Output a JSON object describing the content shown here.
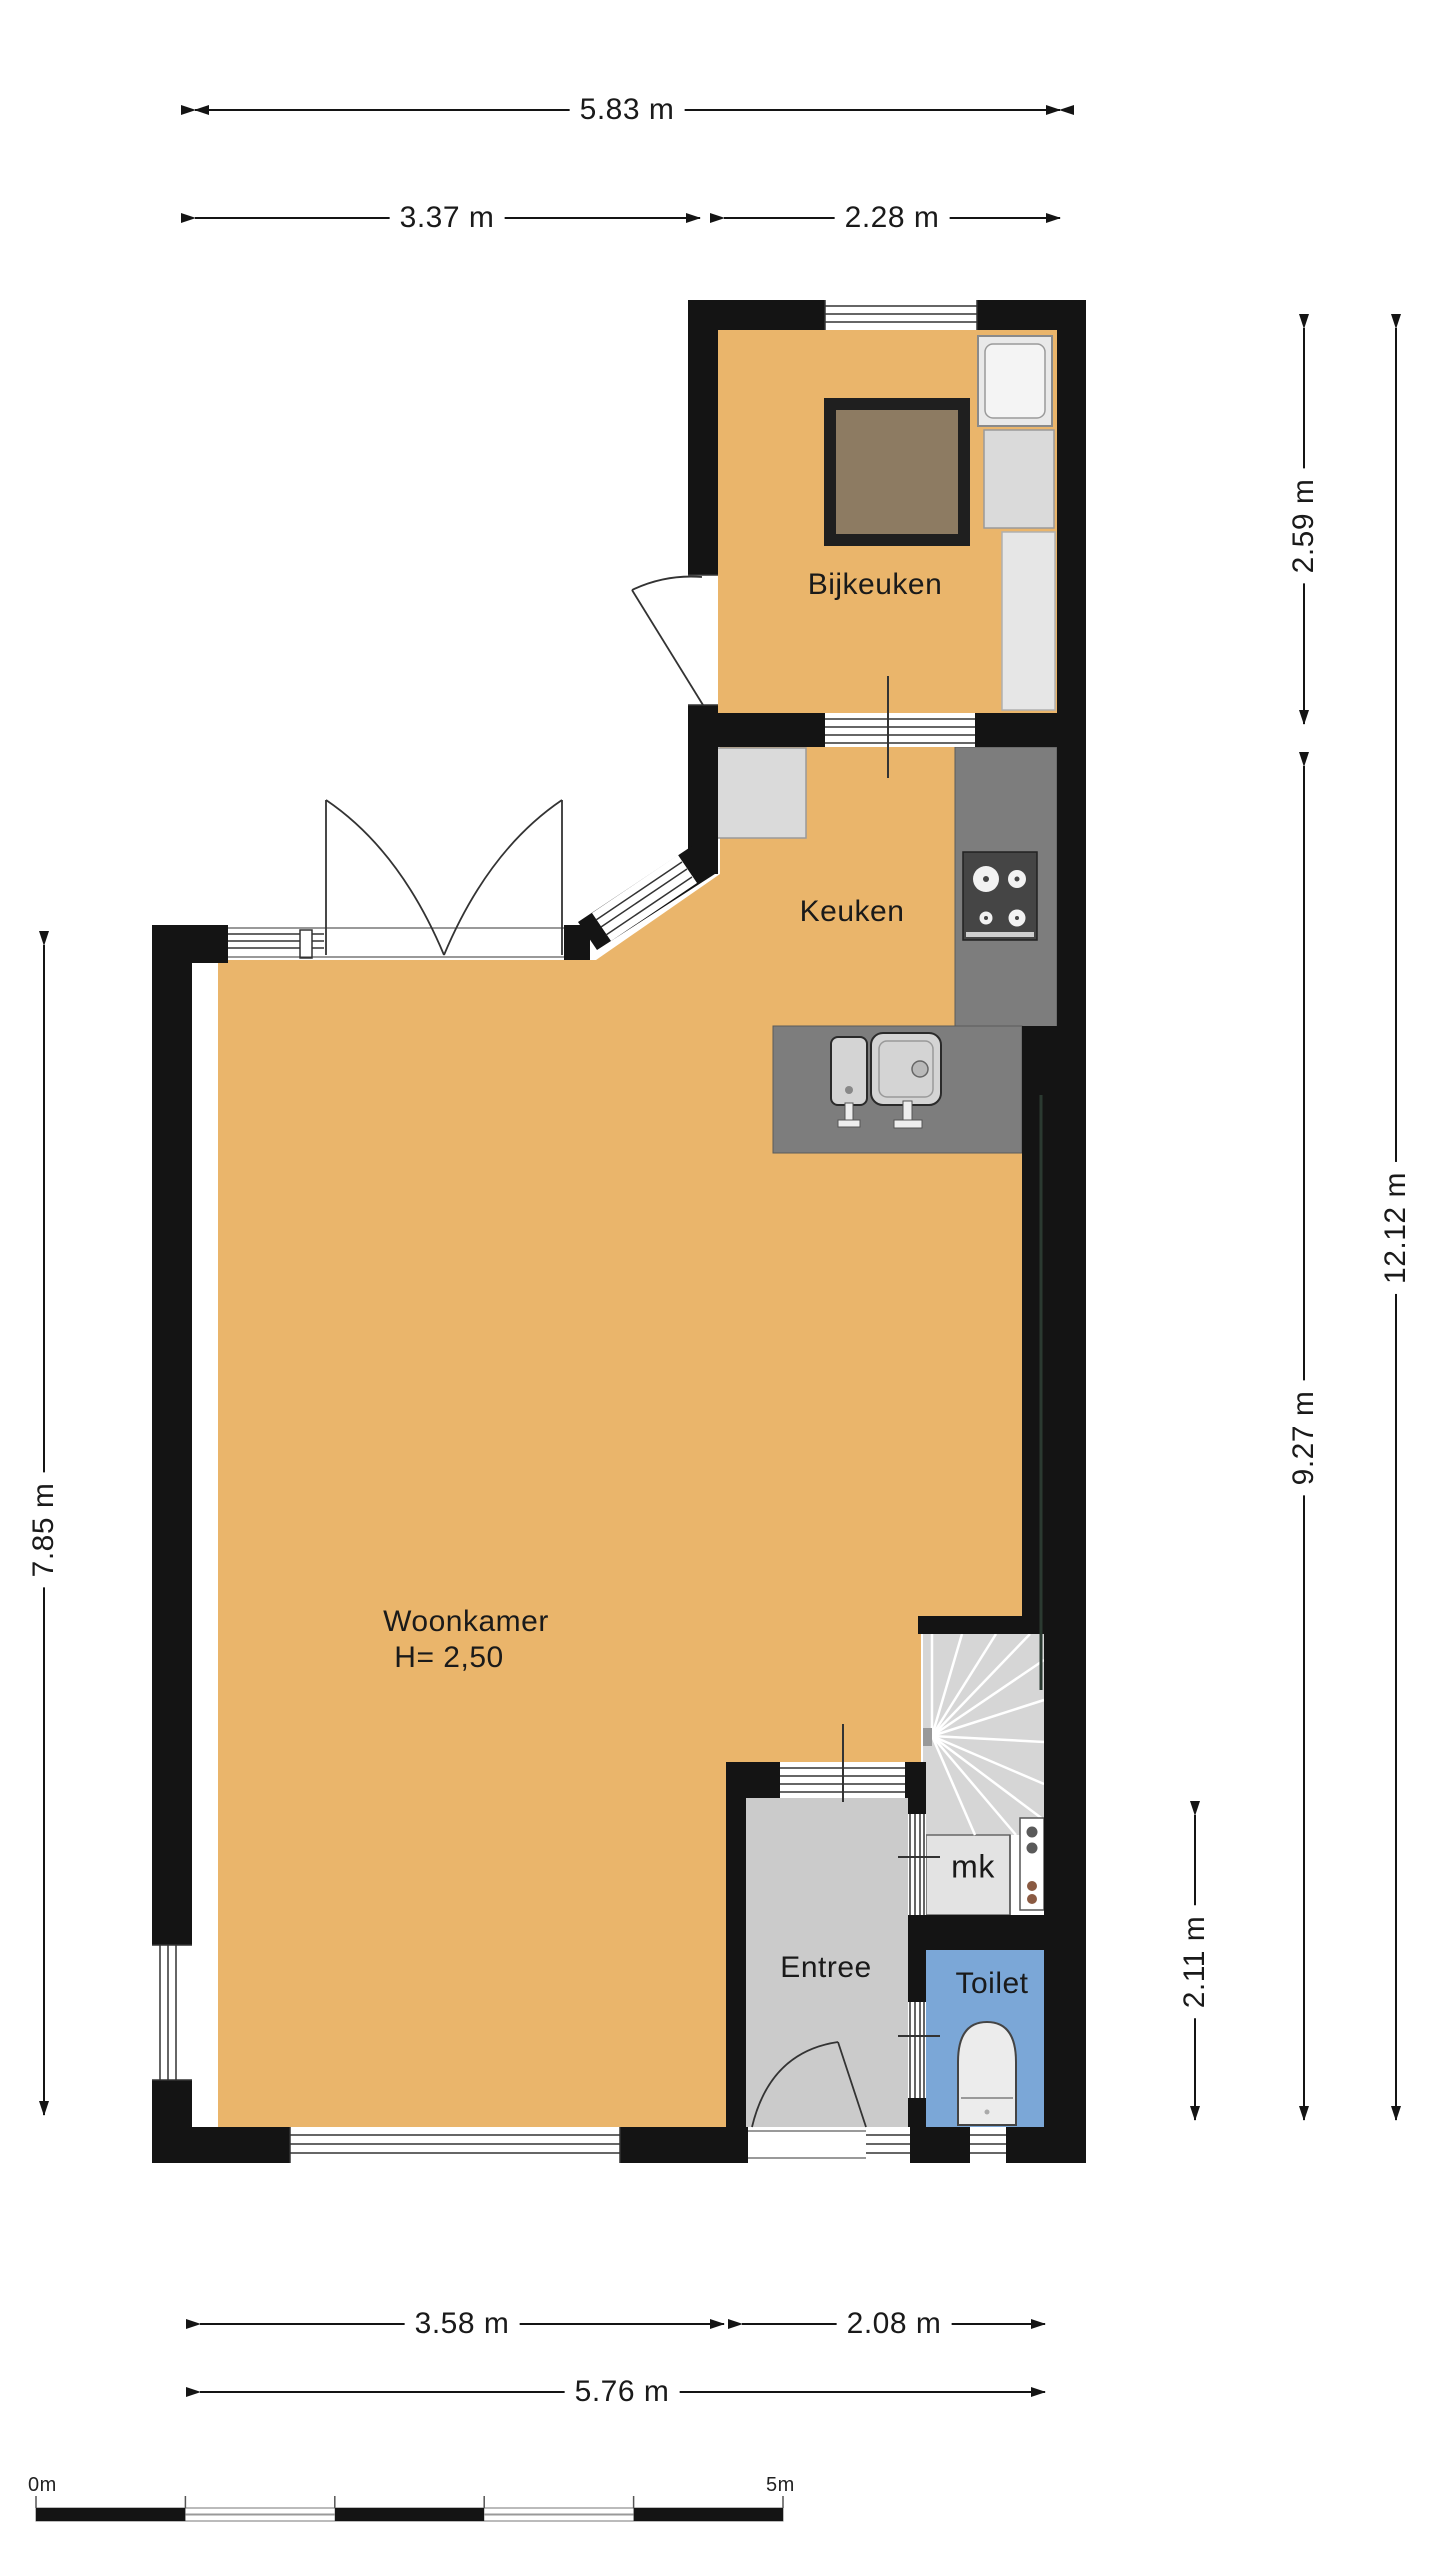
{
  "plan": {
    "rooms": {
      "bijkeuken": {
        "label": "Bijkeuken"
      },
      "keuken": {
        "label": "Keuken"
      },
      "woonkamer": {
        "label": "Woonkamer",
        "note": "H= 2,50"
      },
      "entree": {
        "label": "Entree"
      },
      "mk": {
        "label": "mk"
      },
      "toilet": {
        "label": "Toilet"
      }
    },
    "dimensions": {
      "top_total": "5.83 m",
      "top_left": "3.37 m",
      "top_right": "2.28 m",
      "right_bijkeuken": "2.59 m",
      "right_lower": "9.27 m",
      "right_total": "12.12 m",
      "right_hall": "2.11 m",
      "left_side": "7.85 m",
      "bottom_left": "3.58 m",
      "bottom_right": "2.08 m",
      "bottom_total": "5.76 m"
    },
    "scale_bar": {
      "start": "0m",
      "end": "5m"
    },
    "colors": {
      "wall": "#141414",
      "floor_orange": "#eab56b",
      "floor_entree": "#cbcbcb",
      "floor_toilet": "#7ba7d7",
      "floor_stairs": "#d6d6d6",
      "counter": "#7d7d7d",
      "table_brown": "#8d7b62"
    }
  }
}
